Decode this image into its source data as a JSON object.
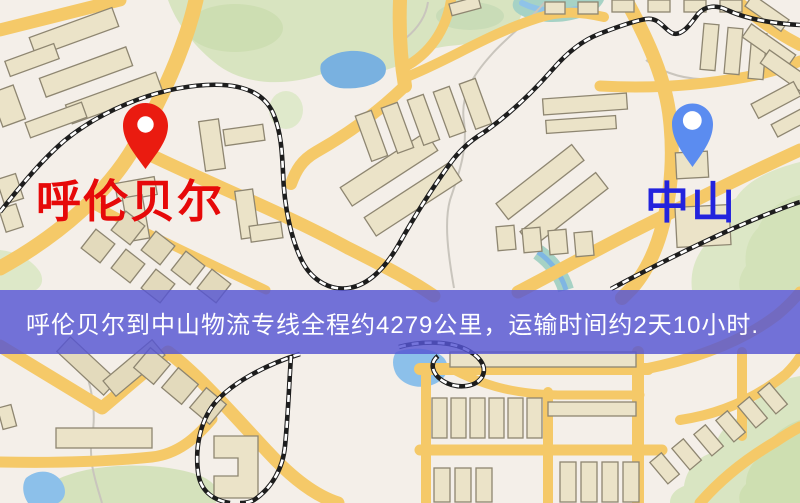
{
  "route": {
    "origin": "呼伦贝尔",
    "destination": "中山",
    "distance_text": "约4279公里",
    "duration_text": "约2天10小时"
  },
  "markers": {
    "origin": {
      "label": "呼伦贝尔",
      "pin_icon": "map-pin",
      "pin_color": "#ea1b10",
      "pin_hole_color": "#ffffff",
      "label_color": "#e60909"
    },
    "destination": {
      "label": "中山",
      "pin_icon": "map-pin",
      "pin_color": "#5b8cf0",
      "pin_hole_color": "#ffffff",
      "label_color": "#2323dd"
    }
  },
  "banner": {
    "text": "呼伦贝尔到中山物流专线全程约4279公里，运输时间约2天10小时.",
    "background_color": "#5656d3",
    "background_opacity": "0.82",
    "text_color": "#ffffff"
  },
  "map_palette": {
    "base": "#f4efe9",
    "road": "#f5c968",
    "building_fill": "#ebe3c8",
    "building_stroke": "#8e8671",
    "park_green": "#d8e4c0",
    "water_blue": "#8cc0ea",
    "river_teal": "#a6d2c5",
    "railway": "#1d1d1d"
  }
}
